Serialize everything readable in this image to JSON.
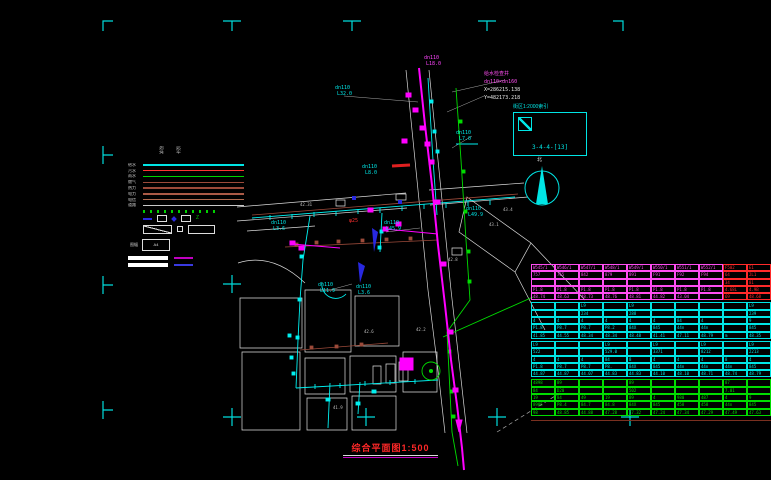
{
  "title_block": {
    "drawing_title": "综合平面图1:500"
  },
  "annotations": {
    "junction_note": {
      "line1": "给水检查井",
      "line2": "dn110×dn160",
      "coord_x": "X=286215.138",
      "coord_y": "Y=482173.218"
    },
    "detail_box": {
      "title": "街区1:2000索引",
      "ref": "3-4-4-[13]"
    },
    "north_label": "北"
  },
  "colors": {
    "background": "#000000",
    "registration": "#00dcdc",
    "water_cyan": "#00f0f0",
    "sewer_magenta": "#ff00ff",
    "rain_green": "#00dc00",
    "existing_brown": "#9c4a3a",
    "title_red": "#ff2828"
  },
  "legend": {
    "headers": [
      "现状",
      "设计"
    ],
    "line_rows": [
      {
        "label": "给水",
        "color": "#00e5e5"
      },
      {
        "label": "污水",
        "color": "#ff3434"
      },
      {
        "label": "雨水",
        "color": "#00d200"
      },
      {
        "label": "燃气",
        "color": "#9c4a3a"
      },
      {
        "label": "热力",
        "color": "#9c4a3a"
      },
      {
        "label": "电力",
        "color": "#aa5a46"
      },
      {
        "label": "电信",
        "color": "#b06a50"
      },
      {
        "label": "道路",
        "color": "#c8c8c8"
      }
    ],
    "frame_label": "图幅",
    "frame_value": "A4"
  },
  "map_labels": [
    {
      "t": "dn110",
      "x": 335,
      "y": 86,
      "c": "#00e5e5"
    },
    {
      "t": "L32.0",
      "x": 337,
      "y": 92,
      "c": "#00e5e5"
    },
    {
      "t": "dn110",
      "x": 456,
      "y": 131,
      "c": "#00e5e5"
    },
    {
      "t": "L7.0",
      "x": 459,
      "y": 137,
      "c": "#00e5e5"
    },
    {
      "t": "dn110",
      "x": 362,
      "y": 165,
      "c": "#00e5e5"
    },
    {
      "t": "L8.0",
      "x": 365,
      "y": 171,
      "c": "#00e5e5"
    },
    {
      "t": "dn110",
      "x": 271,
      "y": 221,
      "c": "#00e5e5"
    },
    {
      "t": "L3.6",
      "x": 273,
      "y": 227,
      "c": "#00e5e5"
    },
    {
      "t": "dn110",
      "x": 384,
      "y": 221,
      "c": "#00e5e5"
    },
    {
      "t": "L45.9",
      "x": 386,
      "y": 227,
      "c": "#00e5e5"
    },
    {
      "t": "dn110",
      "x": 466,
      "y": 207,
      "c": "#00e5e5"
    },
    {
      "t": "L49.9",
      "x": 468,
      "y": 213,
      "c": "#00e5e5"
    },
    {
      "t": "dn110",
      "x": 318,
      "y": 283,
      "c": "#00e5e5"
    },
    {
      "t": "L11.9",
      "x": 320,
      "y": 289,
      "c": "#00e5e5"
    },
    {
      "t": "dn110",
      "x": 356,
      "y": 285,
      "c": "#00e5e5"
    },
    {
      "t": "L3.6",
      "x": 358,
      "y": 291,
      "c": "#00e5e5"
    },
    {
      "t": "dn110",
      "x": 424,
      "y": 56,
      "c": "#ff44ff"
    },
    {
      "t": "L18.0",
      "x": 426,
      "y": 62,
      "c": "#ff44ff"
    },
    {
      "t": "φ25",
      "x": 349,
      "y": 219,
      "c": "#ff3030"
    },
    {
      "t": "42.31",
      "x": 300,
      "y": 203,
      "c": "#c0c0c0",
      "fs": 4
    },
    {
      "t": "42.8",
      "x": 448,
      "y": 258,
      "c": "#c0c0c0",
      "fs": 4
    },
    {
      "t": "43.1",
      "x": 489,
      "y": 223,
      "c": "#c0c0c0",
      "fs": 4
    },
    {
      "t": "42.6",
      "x": 364,
      "y": 330,
      "c": "#c0c0c0",
      "fs": 4
    },
    {
      "t": "41.9",
      "x": 333,
      "y": 406,
      "c": "#c0c0c0",
      "fs": 4
    },
    {
      "t": "42.2",
      "x": 416,
      "y": 328,
      "c": "#c0c0c0",
      "fs": 4
    },
    {
      "t": "43.4",
      "x": 503,
      "y": 208,
      "c": "#c0c0c0",
      "fs": 4
    },
    {
      "t": "北",
      "x": 537,
      "y": 158,
      "c": "#e8e8e8",
      "fs": 5
    }
  ],
  "table": {
    "alt_color": "#ff2a2a",
    "groups": [
      {
        "color": "#ff4df2",
        "rows": [
          [
            "W545/1",
            "W546/1",
            "W547/1",
            "W548/1",
            "W549/1",
            "W550/1",
            "W551/1",
            "W552/1",
            "F502",
            "E1"
          ],
          [
            "757",
            "765",
            "842",
            "879",
            "891",
            "F91",
            "F92",
            "F94",
            "64",
            "2L1"
          ],
          [
            "",
            "",
            "",
            "",
            "",
            "",
            "",
            "",
            "34",
            "81"
          ],
          [
            "P1.8",
            "P1.8",
            "P1.8",
            "P1.8",
            "P1.8",
            "P1.8",
            "P1.8",
            "P1.8",
            "4.68L",
            "4.9B"
          ],
          [
            "48.74",
            "48.63",
            "48.73",
            "48.76",
            "48.81",
            "44.82",
            "43.04",
            "",
            "69",
            "48.68"
          ]
        ]
      },
      {
        "color": "#00e5e5",
        "rows": [
          [
            "",
            "",
            "L9",
            "",
            "L9",
            "",
            "",
            "",
            "",
            "L9"
          ],
          [
            "",
            "",
            "234",
            "",
            "288",
            "",
            "",
            "",
            "",
            "239"
          ],
          [
            "4",
            "4",
            "4",
            "4",
            "4",
            "4",
            "84",
            "4",
            "",
            "9"
          ],
          [
            "P1.8",
            "P8.7",
            "P8.7",
            "P8.2",
            "84X",
            "845",
            "44n",
            "44n",
            "",
            "845"
          ],
          [
            "41.85",
            "44.55",
            "48.34",
            "48.34",
            "48.48",
            "41.41",
            "47.11",
            "48.79",
            "m",
            "48.35"
          ]
        ]
      },
      {
        "color": "#00e5e5",
        "rows": [
          [
            "L9",
            "",
            "",
            "L9",
            "",
            "L9",
            "",
            "L9",
            "",
            "L9"
          ],
          [
            "522",
            "",
            "",
            "529.0",
            "",
            "3371",
            "",
            "8212",
            "",
            "2213"
          ],
          [
            "4",
            "4",
            "4",
            "84",
            "8",
            "4",
            "4",
            "4",
            "8",
            "4"
          ],
          [
            "P1.8",
            "P8.7",
            "P8.7",
            "P8.",
            "84X",
            "845",
            "44n",
            "44n",
            "44n",
            "845"
          ],
          [
            "44.87",
            "44.87",
            "44.07",
            "44.83",
            "44.83",
            "44.10",
            "48.10",
            "48.71",
            "48.74",
            "48.79"
          ]
        ]
      },
      {
        "color": "#00dc00",
        "rows": [
          [
            "4898",
            "89",
            "",
            "",
            "89",
            "",
            "",
            "",
            "87",
            ""
          ],
          [
            "84",
            "D20",
            "",
            "",
            "502",
            "",
            "",
            "",
            "7.01",
            ""
          ],
          [
            "19",
            "84",
            "49",
            "19",
            "89",
            "4",
            "980",
            "487",
            "4",
            "9"
          ],
          [
            "8985",
            "P8.4",
            "84.7",
            "84.8",
            "84X",
            "845",
            "458",
            "458",
            "44n",
            "845"
          ],
          [
            "98",
            "48.85",
            "44.88",
            "47.28",
            "47.32",
            "47.24",
            "47.34",
            "47.29",
            "47.49",
            "47.63"
          ]
        ]
      }
    ]
  }
}
